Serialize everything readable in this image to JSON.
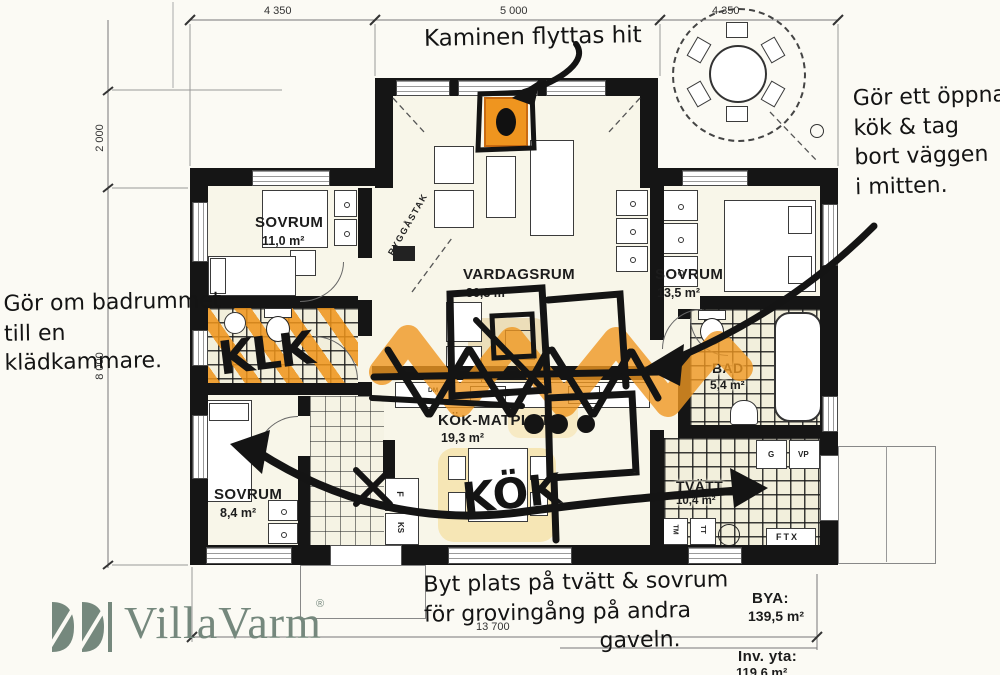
{
  "notes": {
    "kaminen": "Kaminen flyttas hit",
    "open_kitchen": [
      "Gör ett öppnare",
      "kök & tag",
      "bort väggen",
      "i mitten."
    ],
    "bathroom": [
      "Gör om badrummet",
      "till en",
      "klädkammare."
    ],
    "swap": [
      "Byt plats på tvätt & sovrum",
      "för grovingång på andra",
      "gaveln."
    ],
    "klk_marker": "KLK",
    "kok_marker": "KÖK"
  },
  "dimensions": {
    "top_left": "4 350",
    "top_center": "5 000",
    "top_right": "4 350",
    "left_upper": "2 000",
    "left_lower": "8 000",
    "bottom": "13 700"
  },
  "rooms": {
    "sovrum_topleft": {
      "name": "SOVRUM",
      "area": "11,0 m²"
    },
    "vardagsrum": {
      "name": "VARDAGSRUM",
      "area": "30,3 m²"
    },
    "sovrum_right": {
      "name": "SOVRUM",
      "area": "13,5 m²"
    },
    "bad": {
      "name": "BAD",
      "area": "5,4 m²"
    },
    "kok_matplats": {
      "name": "KÖK-MATPLATS",
      "area": "19,3 m²"
    },
    "sovrum_bottomleft": {
      "name": "SOVRUM",
      "area": "8,4 m²"
    },
    "tvatt": {
      "name": "TVÄTT",
      "area": "10,4 m²"
    }
  },
  "plan_labels": {
    "ryggastak": "RYGGÅSTAK",
    "dm": "DM",
    "f": "F",
    "ks": "KS",
    "g": "G",
    "vp": "VP",
    "ftx": "FTX",
    "tm": "TM",
    "tt": "TT"
  },
  "totals": {
    "bya_label": "BYA:",
    "bya_value": "139,5 m²",
    "inv_label": "Inv. yta:",
    "inv_value": "119,6 m²"
  },
  "logo": {
    "text": "VillaVarm",
    "registered": "®"
  },
  "colors": {
    "marker_black": "#141414",
    "highlight_orange": "#ef9722",
    "highlight_yellow": "#f6e3ac",
    "logo_green": "#75887d",
    "wall_black": "#151515"
  }
}
